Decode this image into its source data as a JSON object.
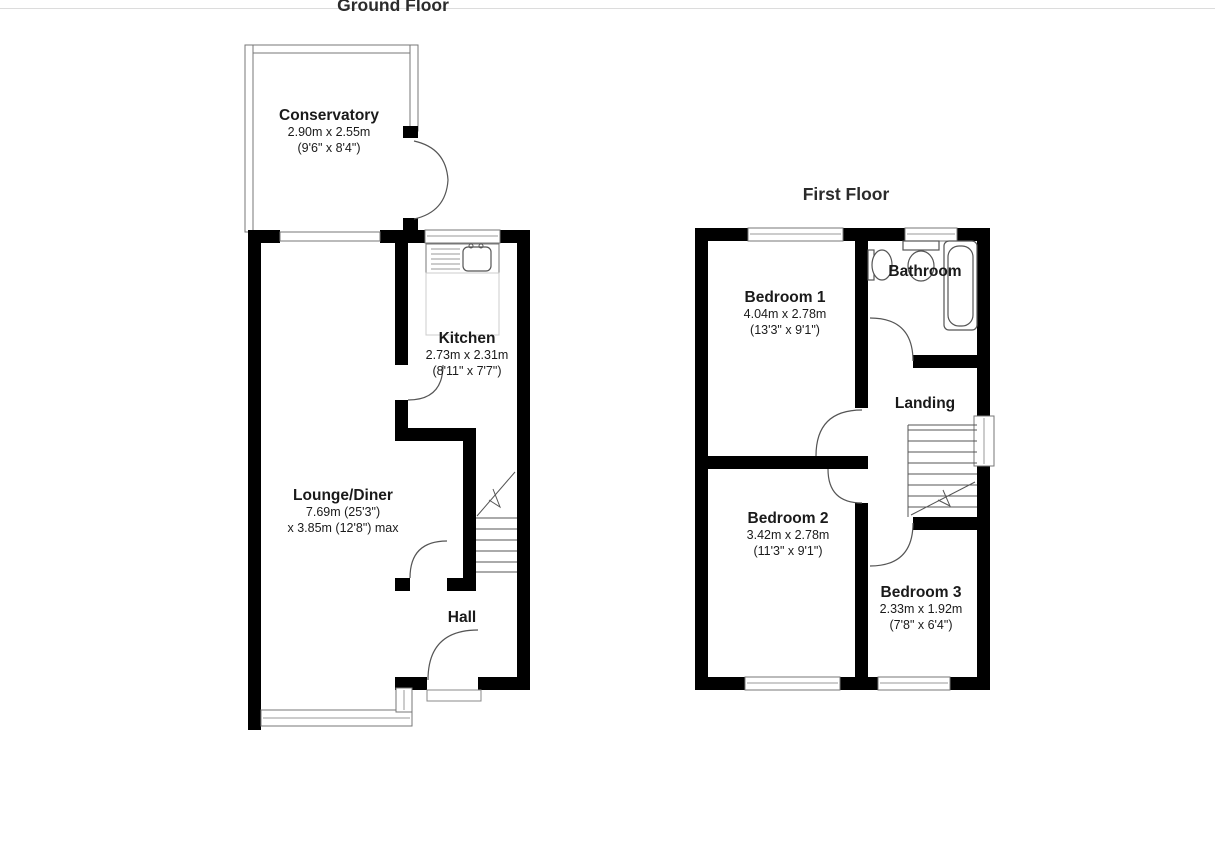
{
  "page": {
    "background": "#ffffff",
    "top_rule_color": "#dcdcdc"
  },
  "colors": {
    "wall": "#000000",
    "door_line": "#555555",
    "glass_line": "#777777",
    "text": "#1a1a1a"
  },
  "ground_floor": {
    "title": "Ground Floor",
    "rooms": {
      "conservatory": {
        "name": "Conservatory",
        "metric": "2.90m x 2.55m",
        "imperial": "(9'6\" x 8'4\")"
      },
      "kitchen": {
        "name": "Kitchen",
        "metric": "2.73m x 2.31m",
        "imperial": "(8'11\" x 7'7\")"
      },
      "lounge_diner": {
        "name": "Lounge/Diner",
        "metric": "7.69m (25'3\")",
        "imperial": "x 3.85m (12'8\") max"
      },
      "hall": {
        "name": "Hall"
      }
    }
  },
  "first_floor": {
    "title": "First Floor",
    "rooms": {
      "bedroom_1": {
        "name": "Bedroom 1",
        "metric": "4.04m x 2.78m",
        "imperial": "(13'3\" x 9'1\")"
      },
      "bathroom": {
        "name": "Bathroom"
      },
      "landing": {
        "name": "Landing"
      },
      "bedroom_2": {
        "name": "Bedroom 2",
        "metric": "3.42m x 2.78m",
        "imperial": "(11'3\" x 9'1\")"
      },
      "bedroom_3": {
        "name": "Bedroom 3",
        "metric": "2.33m x 1.92m",
        "imperial": "(7'8\" x 6'4\")"
      }
    }
  }
}
